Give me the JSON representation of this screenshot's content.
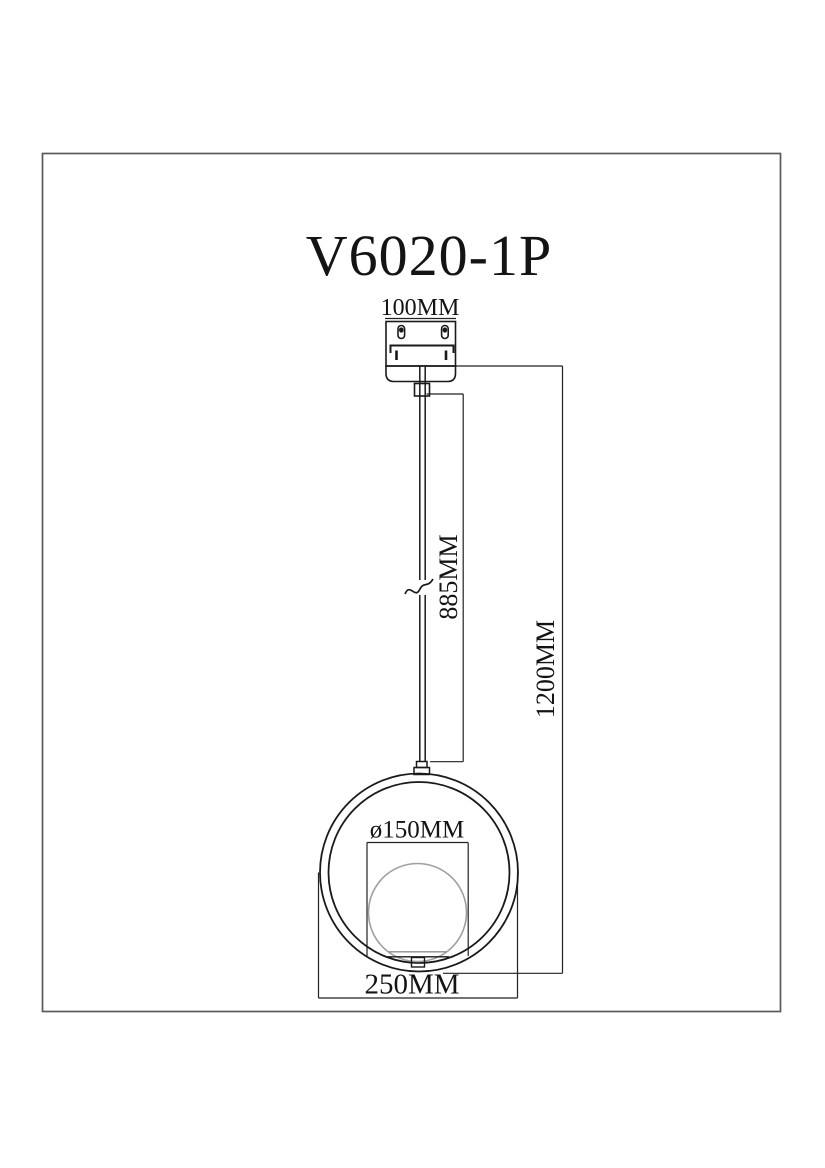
{
  "drawing": {
    "title": "V6020-1P",
    "labels": {
      "canopy_width": "100MM",
      "cord_length": "885MM",
      "overall_height": "1200MM",
      "globe_diameter": "ø150MM",
      "ring_width": "250MM"
    },
    "colors": {
      "line": "#1a1a1a",
      "frame_border": "#5a5a5a",
      "globe_outline": "#9f9f9f",
      "background": "#ffffff"
    }
  }
}
